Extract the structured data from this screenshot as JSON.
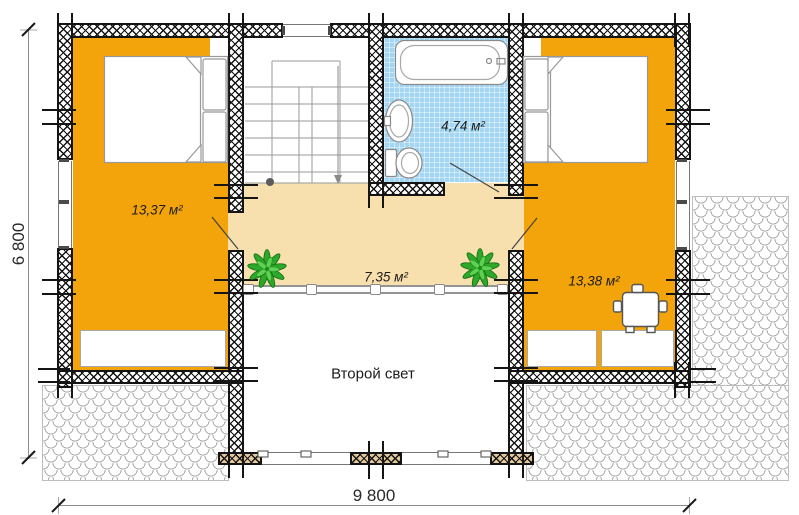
{
  "rooms": {
    "bedroom_left": {
      "area_label": "13,37 м²"
    },
    "bathroom": {
      "area_label": "4,74 м²"
    },
    "bedroom_right": {
      "area_label": "13,38 м²"
    },
    "hall": {
      "area_label": "7,35 м²"
    },
    "void": {
      "label": "Второй свет"
    }
  },
  "dimensions": {
    "overall_width_mm": "9 800",
    "overall_depth_mm": "6 800"
  },
  "colors": {
    "room_fill": "#f3a40a",
    "hall_fill": "#f7dfae",
    "bath_fill": "#a3d6f3",
    "plant_green": "#2ea82a",
    "wall_ink": "#141414",
    "line_gray": "#909090"
  },
  "icons": [
    "bed-icon",
    "pillow-icon",
    "bathtub-icon",
    "sink-icon",
    "toilet-icon",
    "stairs-icon",
    "stair-arrow-icon",
    "door-leaf-icon",
    "table-icon",
    "stool-icon",
    "plant-icon",
    "railing",
    "roof-tiles",
    "log-end-marks",
    "dimension-tick"
  ]
}
